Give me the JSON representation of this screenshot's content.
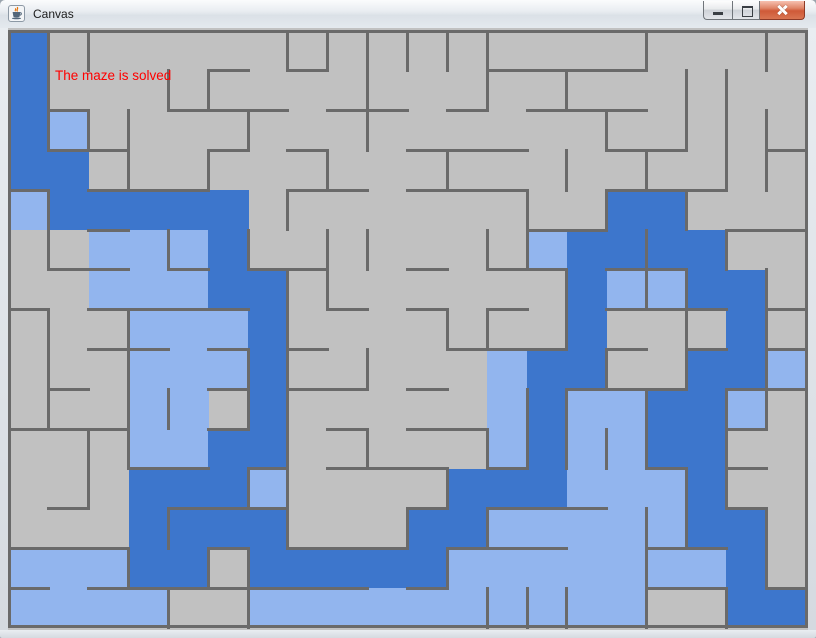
{
  "window": {
    "title": "Canvas",
    "icon": "java-coffee-cup-icon",
    "buttons": [
      {
        "name": "minimize",
        "icon": "minimize-icon"
      },
      {
        "name": "maximize",
        "icon": "maximize-icon"
      },
      {
        "name": "close",
        "icon": "close-icon"
      }
    ]
  },
  "status": {
    "text": "The maze is solved",
    "color": "#ff0000"
  },
  "maze": {
    "cols": 20,
    "rows": 15,
    "palette": {
      "G": "#c1c1c1",
      "L": "#92b5ee",
      "D": "#3d76cc",
      "wall": "#6a6a6a",
      "legend": {
        "G": "unvisited",
        "L": "visited",
        "D": "solution-path"
      }
    },
    "grid": [
      "DGGGGGGGGGGGGGGGGGGG",
      "DGGGGGGGGGGGGGGGGGGG",
      "DLGGGGGGGGGGGGGGGGGG",
      "DDGGGGGGGGGGGGGGGGGG",
      "LDDDDDGGGGGGGGGDDGGG",
      "GGLLLDGGGGGGGLDDDDGG",
      "GGLLLDDGGGGGGGDLLDDG",
      "GGGLLLDGGGGGGGDGGGDG",
      "GGGLLLDGGGGGLDDGGDDL",
      "GGGLLGDGGGGGLDLLDDLG",
      "GGGLLDDGGGGGLDLLDDGG",
      "GGGDDDLGGGGDDDLLLDGG",
      "GGGDDDDGGGDDLLLLLDDG",
      "LLLDDGDDDDDLLLLLLLDG",
      "LLLLGGLLLLLLLLLLGGDD"
    ],
    "vwalls": [
      [
        0,
        1,
        6,
        7,
        8,
        9,
        10,
        11,
        15,
        18
      ],
      [
        0,
        3,
        4,
        8,
        11,
        13,
        16,
        17
      ],
      [
        0,
        1,
        2,
        5,
        8,
        14,
        16,
        17,
        18
      ],
      [
        2,
        4,
        7,
        10,
        13,
        15,
        17,
        18
      ],
      [
        0,
        6,
        12,
        14,
        16
      ],
      [
        0,
        3,
        5,
        7,
        8,
        11,
        12,
        15,
        17
      ],
      [
        6,
        7,
        13,
        15,
        16,
        18
      ],
      [
        0,
        2,
        6,
        10,
        11,
        13,
        16,
        18
      ],
      [
        0,
        2,
        5,
        6,
        8,
        14,
        16,
        18
      ],
      [
        0,
        2,
        3,
        5,
        6,
        12,
        13,
        15,
        17,
        18
      ],
      [
        1,
        2,
        6,
        8,
        11,
        12,
        13,
        14,
        15,
        17
      ],
      [
        1,
        5,
        6,
        10,
        16,
        17
      ],
      [
        3,
        6,
        9,
        11,
        15,
        16,
        18
      ],
      [
        2,
        4,
        5,
        10,
        15,
        18
      ],
      [
        3,
        5,
        11,
        12,
        13,
        15,
        17
      ]
    ],
    "hwalls": [
      [
        5,
        7,
        12,
        13,
        14,
        15
      ],
      [
        1,
        4,
        5,
        6,
        8,
        9,
        11,
        13,
        14,
        15
      ],
      [
        1,
        2,
        5,
        7,
        10,
        11,
        12,
        15,
        16,
        19
      ],
      [
        0,
        2,
        3,
        4,
        7,
        8,
        10,
        11,
        12,
        15,
        16,
        17
      ],
      [
        2,
        13,
        14,
        18,
        19
      ],
      [
        1,
        2,
        4,
        6,
        7,
        10,
        12,
        13,
        15,
        16
      ],
      [
        0,
        2,
        3,
        4,
        5,
        8,
        10,
        12,
        15,
        16,
        17,
        19
      ],
      [
        2,
        3,
        5,
        7,
        11,
        12,
        13,
        15,
        17,
        19
      ],
      [
        1,
        5,
        7,
        8,
        10,
        14,
        15,
        16,
        18,
        19
      ],
      [
        0,
        1,
        2,
        5,
        8,
        10,
        11,
        18
      ],
      [
        3,
        4,
        6,
        8,
        9,
        10,
        12,
        16,
        18
      ],
      [
        1,
        4,
        5,
        6,
        10,
        12,
        13,
        14,
        18
      ],
      [
        0,
        1,
        2,
        5,
        7,
        8,
        9,
        11,
        12,
        13,
        16,
        17
      ],
      [
        0,
        2,
        3,
        4,
        5,
        6,
        7,
        8,
        10,
        16,
        17,
        19
      ]
    ]
  }
}
